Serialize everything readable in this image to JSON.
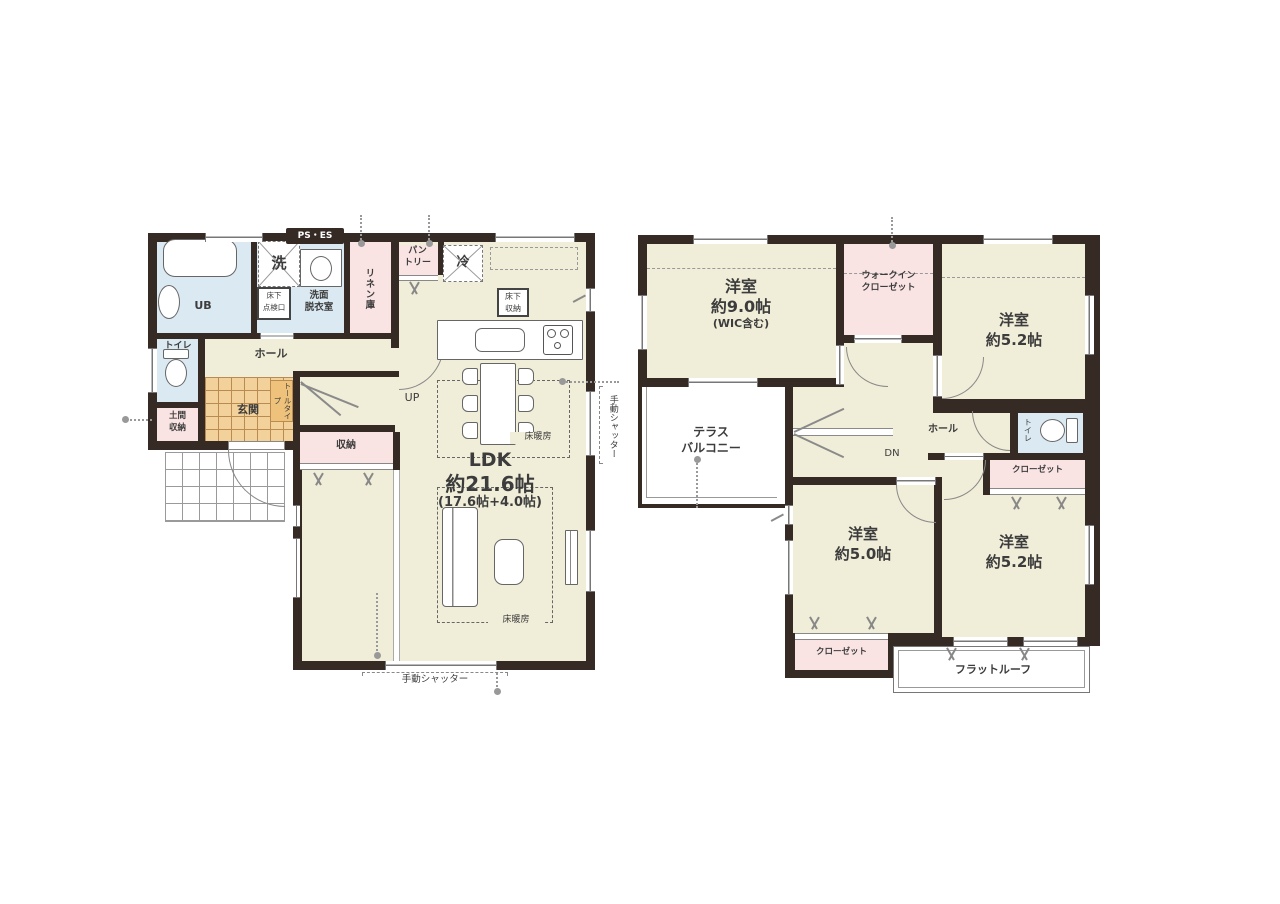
{
  "colors": {
    "wall": "#352b24",
    "room_cream": "#f0edd8",
    "wet_blue": "#dbe9f2",
    "storage_pink": "#f9e4e3",
    "entrance_tile": "#f2d19b",
    "cabinet_orange": "#eec27b"
  },
  "floor1": {
    "ps_es": "PS・ES",
    "laundry": "洗",
    "washroom": "洗面\n脱衣室",
    "inspection_hatch": "床下\n点検口",
    "bath": "UB",
    "linen": "リネン庫",
    "pantry": "パン\nトリー",
    "fridge": "冷",
    "underfloor_storage": "床下\n収納",
    "toilet": "トイレ",
    "hall": "ホール",
    "entrance": "玄関",
    "tall_cabinet": "トールタイプ",
    "doma_storage": "土間\n収納",
    "stairs_up": "UP",
    "storage": "収納",
    "ldk": "LDK",
    "ldk_size": "約21.6帖",
    "ldk_breakdown": "(17.6帖+4.0帖)",
    "floor_heating": "床暖房",
    "manual_shutter": "手動シャッター"
  },
  "floor2": {
    "room9": {
      "name": "洋室",
      "size": "約9.0帖",
      "note": "(WIC含む)"
    },
    "wic": "ウォークイン\nクローゼット",
    "room52a": {
      "name": "洋室",
      "size": "約5.2帖"
    },
    "terrace": "テラス\nバルコニー",
    "hall": "ホール",
    "stairs_down": "DN",
    "toilet": "トイレ",
    "closet_right": "クローゼット",
    "room50": {
      "name": "洋室",
      "size": "約5.0帖"
    },
    "room52b": {
      "name": "洋室",
      "size": "約5.2帖"
    },
    "closet_bottom": "クローゼット",
    "flat_roof": "フラットルーフ"
  }
}
